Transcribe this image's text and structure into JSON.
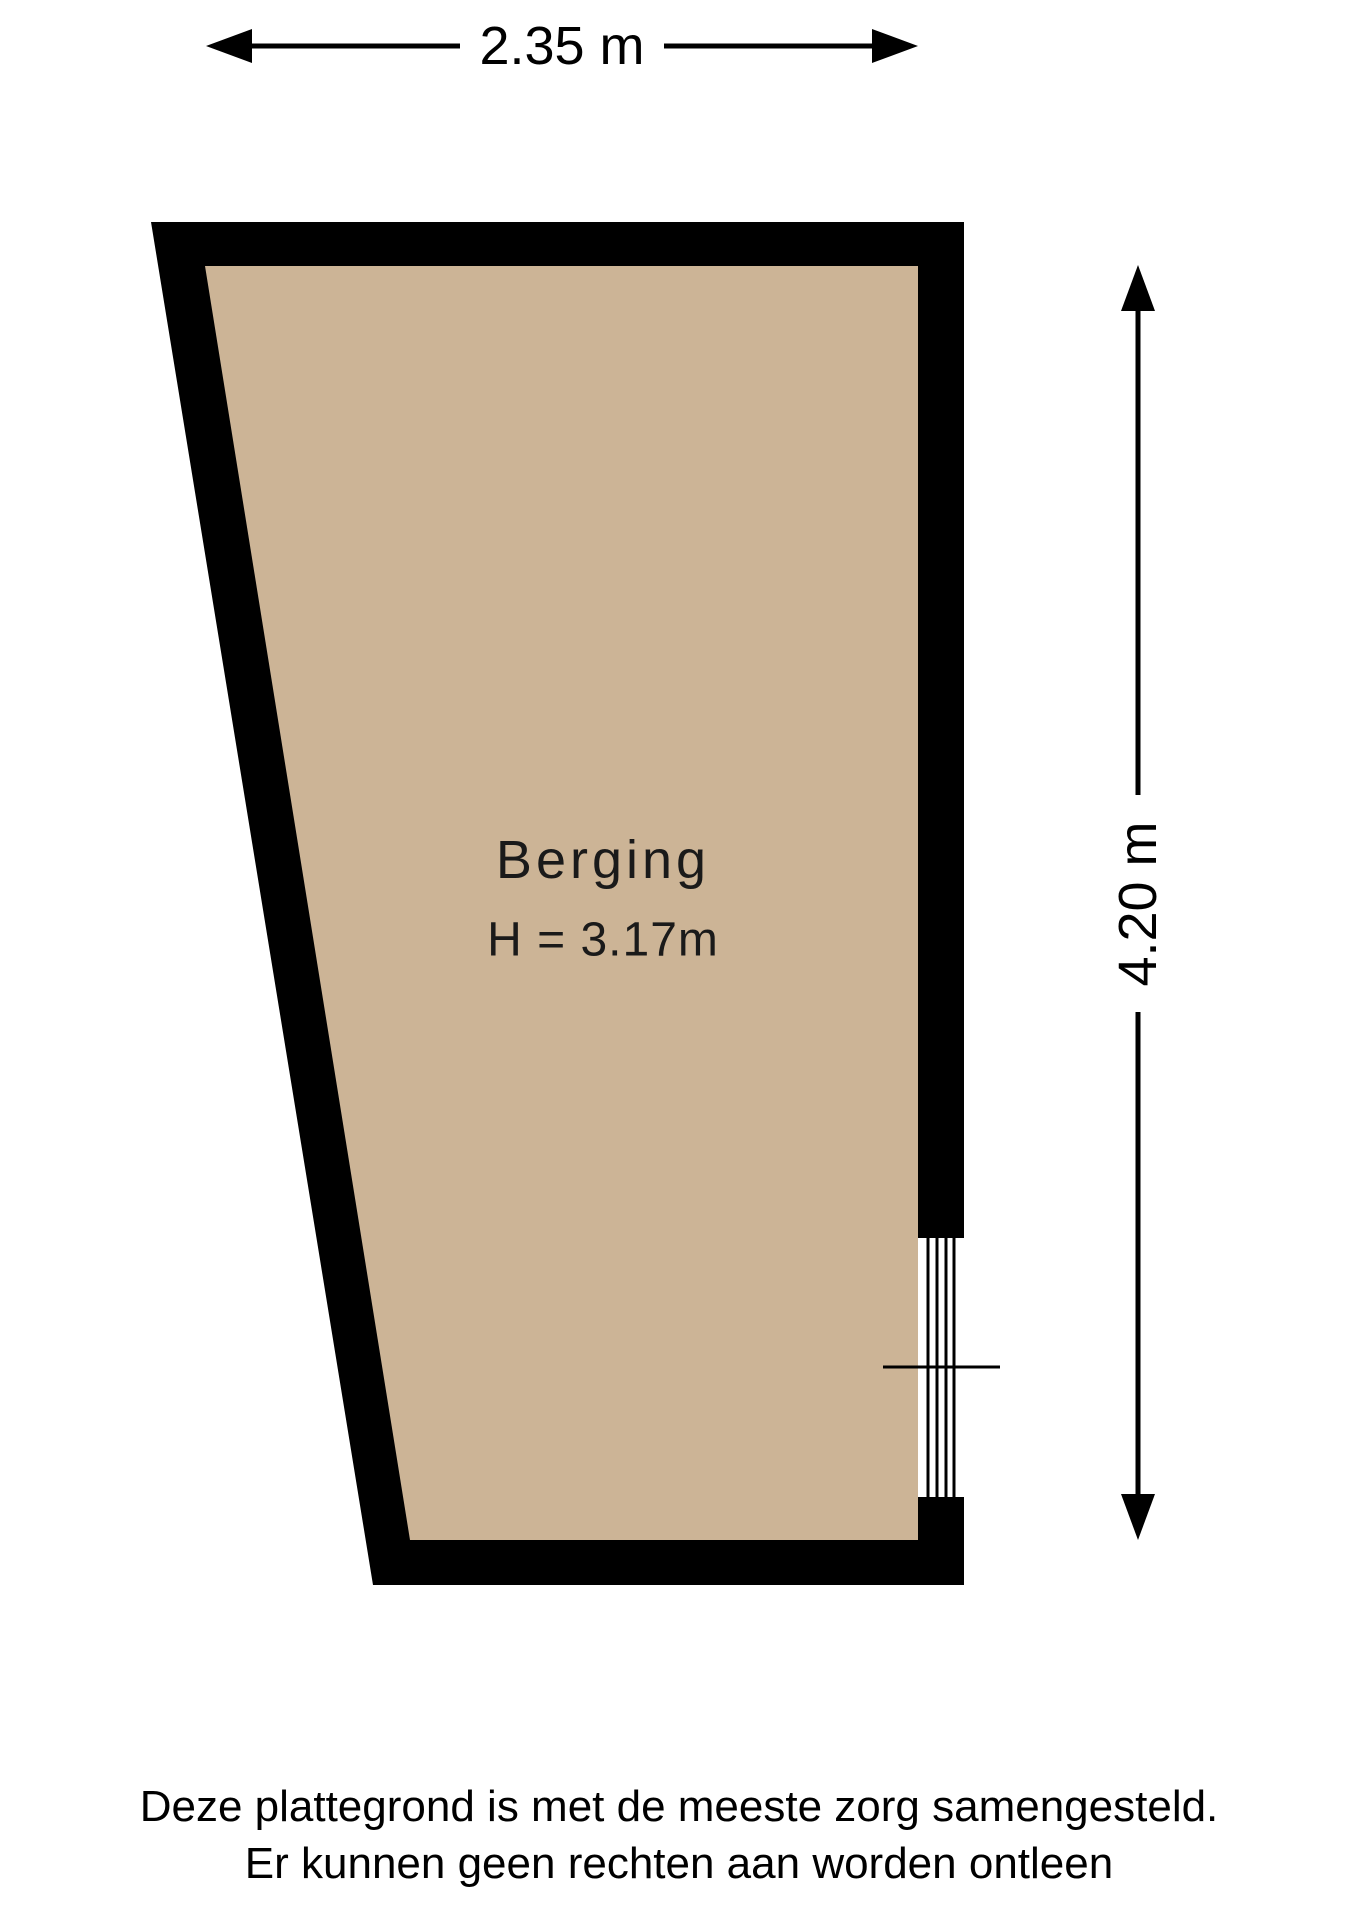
{
  "plan": {
    "room": {
      "name": "Berging",
      "ceiling_height_label": "H = 3.17m"
    },
    "dimensions": {
      "width_label": "2.35 m",
      "depth_label": "4.20 m"
    },
    "colors": {
      "wall": "#000000",
      "floor": "#ccb496",
      "line": "#000000",
      "background": "#ffffff"
    }
  },
  "footer": {
    "line1": "Deze plattegrond is met de meeste zorg samengesteld.",
    "line2": "Er kunnen geen rechten aan worden ontleen"
  }
}
